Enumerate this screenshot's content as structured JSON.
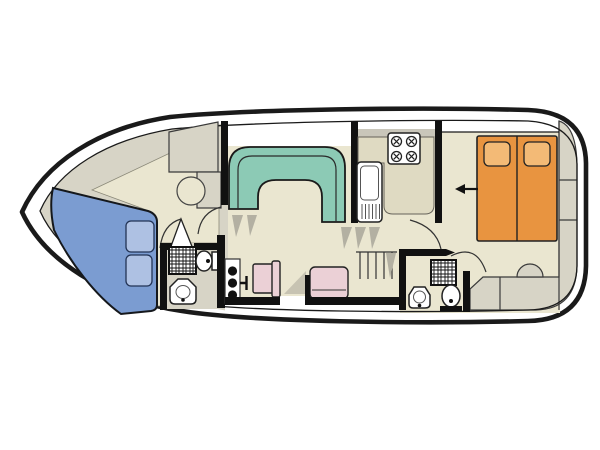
{
  "figure": {
    "kind": "boat-floor-plan",
    "orientation": "bow-left-stern-right"
  },
  "colors": {
    "background": "#ffffff",
    "hull_stroke": "#1a1a1a",
    "deck_white": "#ffffff",
    "floor_beige": "#eae6d0",
    "deck_gray": "#d7d4c6",
    "counter": "#dfdac2",
    "counter_back": "#c9c6ba",
    "shadow_gray": "#b3b0a2",
    "sofa_teal": "#8ccab5",
    "bed_blue": "#7b9cd1",
    "pillow_blue": "#aec1e3",
    "bed_orange": "#e89440",
    "pillow_orange": "#f3ba76",
    "seat_pink": "#ebd0d6",
    "fixture_white": "#ffffff",
    "line_dark": "#111111"
  },
  "items": {
    "bow_cabin": [
      "v-berth-double-bed",
      "two-pillows",
      "wardrobe",
      "round-stool",
      "ensuite-door"
    ],
    "bow_bathroom": [
      "shower",
      "toilet",
      "washbasin"
    ],
    "salon": [
      "u-shaped-sofa",
      "steps",
      "helm-console",
      "helm-seat",
      "side-seat",
      "side-door"
    ],
    "galley": [
      "stove-4-burners",
      "sink-with-drainer",
      "worktop",
      "stairs"
    ],
    "aft_cabin": [
      "double-bed-two-mattresses",
      "two-pillows",
      "entry-arrow",
      "cabin-door"
    ],
    "aft_bathroom": [
      "shower",
      "toilet",
      "washbasin"
    ],
    "stern": [
      "bench-seating",
      "round-seat",
      "side-lockers"
    ]
  }
}
